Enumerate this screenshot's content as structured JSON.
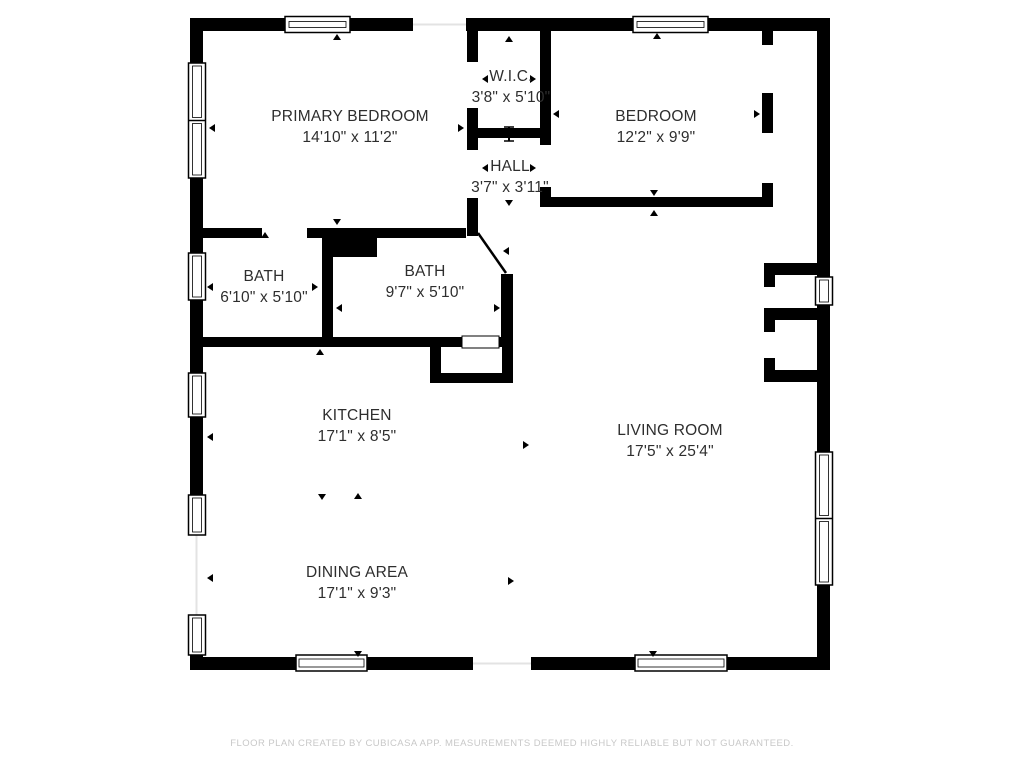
{
  "floor_plan": {
    "rooms": {
      "primary_bedroom": {
        "name": "PRIMARY BEDROOM",
        "dims": "14'10\" x 11'2\""
      },
      "wic": {
        "name": "W.I.C.",
        "dims": "3'8\" x 5'10\""
      },
      "hall": {
        "name": "HALL",
        "dims": "3'7\" x 3'11\""
      },
      "bedroom": {
        "name": "BEDROOM",
        "dims": "12'2\" x 9'9\""
      },
      "bath_ensuite": {
        "name": "BATH",
        "dims": "6'10\" x 5'10\""
      },
      "bath_main": {
        "name": "BATH",
        "dims": "9'7\" x 5'10\""
      },
      "kitchen": {
        "name": "KITCHEN",
        "dims": "17'1\" x 8'5\""
      },
      "living_room": {
        "name": "LIVING ROOM",
        "dims": "17'5\" x 25'4\""
      },
      "dining_area": {
        "name": "DINING AREA",
        "dims": "17'1\" x 9'3\""
      }
    },
    "footer": {
      "disclaimer": "FLOOR PLAN CREATED BY CUBICASA APP. MEASUREMENTS DEEMED HIGHLY RELIABLE BUT NOT GUARANTEED."
    },
    "colors": {
      "wall": "#000000",
      "background": "#ffffff",
      "label_text": "#2e2e2e",
      "disclaimer_text": "#c8c8c8"
    }
  }
}
